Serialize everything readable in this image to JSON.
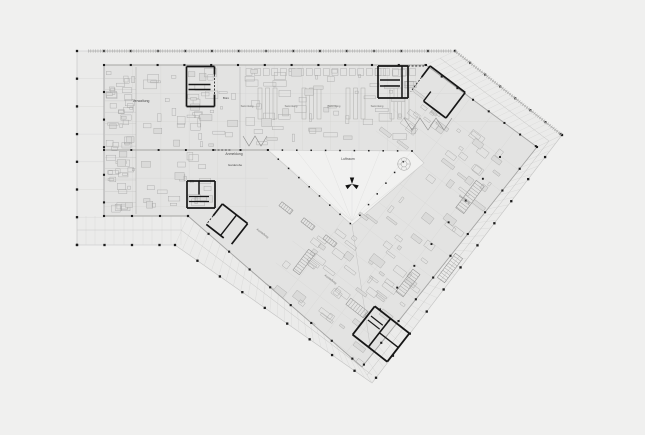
{
  "drawing_title": "floor-plan",
  "colors": {
    "bg": "#f0f0ef",
    "terrace": "#ebebea",
    "plate": "#e3e3e2",
    "void": "#f1f1f0",
    "gridLight": "#d7d7d6",
    "gridMid": "#c6c6c5",
    "edge": "#a4a4a3",
    "edgeLight": "#c2c2c1",
    "wall": "#161616",
    "column": "#1c1c1c",
    "clutter": "#a6a6a5",
    "clutterFill": "#dadad9",
    "text": "#4a4a4a",
    "textFaint": "#6e6e6d",
    "ruler": "#b2b2b1",
    "fan": "#dcdcdb"
  },
  "labels": [
    {
      "t": "Verwaltung",
      "x": 141,
      "y": 102,
      "s": 3.4,
      "r": 0
    },
    {
      "t": "Büro",
      "x": 226,
      "y": 99,
      "s": 3.0,
      "r": 0
    },
    {
      "t": "Anmeldung",
      "x": 234,
      "y": 155,
      "s": 3.4,
      "r": 0
    },
    {
      "t": "Garderobe",
      "x": 235,
      "y": 166,
      "s": 3.0,
      "r": 0
    },
    {
      "t": "Luftraum",
      "x": 348,
      "y": 160,
      "s": 3.4,
      "r": 0
    },
    {
      "t": "Sammlung",
      "x": 247,
      "y": 107,
      "s": 2.7,
      "r": 0
    },
    {
      "t": "Sammlung",
      "x": 291,
      "y": 107,
      "s": 2.7,
      "r": 0
    },
    {
      "t": "Sammlung",
      "x": 334,
      "y": 107,
      "s": 2.7,
      "r": 0
    },
    {
      "t": "Sammlung",
      "x": 377,
      "y": 107,
      "s": 2.7,
      "r": 0
    },
    {
      "t": "Sammlung",
      "x": 464,
      "y": 200,
      "s": 2.8,
      "r": 37
    },
    {
      "t": "Ausstellung",
      "x": 262,
      "y": 234,
      "s": 2.8,
      "r": 37
    },
    {
      "t": "Ausstellung",
      "x": 330,
      "y": 280,
      "s": 2.8,
      "r": 37
    }
  ],
  "geometry": {
    "terrace": [
      [
        77,
        51
      ],
      [
        455,
        51
      ],
      [
        562,
        135
      ],
      [
        372,
        383
      ],
      [
        175,
        245
      ],
      [
        77,
        245
      ]
    ],
    "plate": [
      [
        104,
        65
      ],
      [
        426,
        65
      ],
      [
        537,
        147
      ],
      [
        362,
        367
      ],
      [
        188,
        216
      ],
      [
        104,
        216
      ]
    ],
    "void": [
      [
        268,
        150
      ],
      [
        412,
        151
      ],
      [
        424,
        163
      ],
      [
        352,
        225
      ]
    ],
    "fanHub": [
      352,
      221
    ],
    "fanTargets": [
      [
        268,
        150
      ],
      [
        296,
        150
      ],
      [
        324,
        150
      ],
      [
        352,
        150
      ],
      [
        380,
        151
      ],
      [
        412,
        151
      ],
      [
        424,
        163
      ],
      [
        305,
        186
      ]
    ],
    "wingA": {
      "vxs": [
        132.6,
        160.9,
        189.2,
        217.5,
        245.8,
        274.1,
        302.4,
        330.7,
        359.0,
        387.3,
        415.6
      ],
      "vSplit": 268,
      "vy1": 51,
      "vy2a": 216,
      "vy2b": 150,
      "hys": [
        93.3,
        121.6,
        178.2,
        206.5
      ],
      "hx1": 104,
      "diagX0": 426,
      "diagY0": 65,
      "diagSlope": 1.354,
      "hx2low": 268
    },
    "leftBandYs": [
      78.7,
      106.4,
      134.1,
      161.8,
      189.5,
      217.2
    ],
    "bottomBandXs": [
      86,
      95,
      105,
      114,
      124,
      133,
      143,
      152,
      162,
      171,
      181
    ],
    "wingB": {
      "origin": [
        426,
        65
      ],
      "angle": 37.2,
      "width": 138,
      "length": 300,
      "step": 27.6
    },
    "hatches": [
      {
        "a1": [
          426,
          65
        ],
        "a2": [
          537,
          147
        ],
        "b1": [
          455,
          51
        ],
        "b2": [
          562,
          135
        ],
        "n": 22,
        "w": 0.4
      },
      {
        "a1": [
          537,
          147
        ],
        "a2": [
          362,
          367
        ],
        "b1": [
          562,
          135
        ],
        "b2": [
          372,
          383
        ],
        "n": 32,
        "w": 0.4
      },
      {
        "a1": [
          188,
          216
        ],
        "a2": [
          362,
          367
        ],
        "b1": [
          175,
          245
        ],
        "b2": [
          372,
          383
        ],
        "n": 27,
        "w": 0.4
      }
    ],
    "midlines": [
      {
        "p1": [
          181,
          230
        ],
        "p2": [
          372,
          375
        ],
        "w": 0.5
      },
      {
        "p1": [
          549,
          141
        ],
        "p2": [
          367,
          375
        ],
        "w": 0.5
      },
      {
        "p1": [
          77,
          230
        ],
        "p2": [
          182,
          230
        ],
        "w": 0.4
      },
      {
        "p1": [
          440,
          58
        ],
        "p2": [
          549,
          141
        ],
        "w": 0.5
      },
      {
        "p1": [
          352,
          225
        ],
        "p2": [
          371,
          352
        ],
        "w": 0.5
      }
    ],
    "rulers": [
      {
        "p1": [
          88,
          51
        ],
        "p2": [
          452,
          51
        ]
      },
      {
        "p1": [
          455,
          51
        ],
        "p2": [
          562,
          135
        ]
      }
    ],
    "walls": [
      {
        "p1": [
          104,
          150
        ],
        "p2": [
          268,
          150
        ],
        "w": 0.9
      },
      {
        "p1": [
          136,
          67
        ],
        "p2": [
          136,
          214
        ],
        "w": 0.5
      },
      {
        "p1": [
          104,
          216
        ],
        "p2": [
          188,
          216
        ],
        "w": 1.1
      },
      {
        "p1": [
          240,
          67
        ],
        "p2": [
          240,
          148
        ],
        "w": 0.45
      }
    ],
    "dashes": [
      [
        408,
        66,
        424,
        66
      ],
      [
        214,
        150,
        232,
        150
      ]
    ],
    "columnRuns": [
      {
        "f": [
          77,
          51
        ],
        "t": [
          455,
          51
        ],
        "st": 27.0,
        "s": 2.3
      },
      {
        "f": [
          77,
          78.7
        ],
        "t": [
          77,
          245
        ],
        "st": 27.7,
        "s": 2.3
      },
      {
        "f": [
          104,
          65
        ],
        "t": [
          426,
          65
        ],
        "st": 26.8,
        "s": 2.1
      },
      {
        "f": [
          104,
          92
        ],
        "t": [
          104,
          216
        ],
        "st": 27.6,
        "s": 2.1
      },
      {
        "f": [
          104,
          216
        ],
        "t": [
          188,
          216
        ],
        "st": 28.0,
        "s": 2.1
      },
      {
        "f": [
          77,
          245
        ],
        "t": [
          175,
          245
        ],
        "st": 27.5,
        "s": 2.3
      },
      {
        "f": [
          455,
          51
        ],
        "t": [
          562,
          135
        ],
        "st": 19.2,
        "s": 2.2
      },
      {
        "f": [
          426,
          65
        ],
        "t": [
          537,
          147
        ],
        "st": 19.5,
        "s": 2.0
      },
      {
        "f": [
          562,
          135
        ],
        "t": [
          372,
          383
        ],
        "st": 27.8,
        "s": 2.3
      },
      {
        "f": [
          537,
          147
        ],
        "t": [
          362,
          367
        ],
        "st": 27.8,
        "s": 2.1
      },
      {
        "f": [
          175,
          245
        ],
        "t": [
          372,
          383
        ],
        "st": 27.4,
        "s": 2.3
      },
      {
        "f": [
          188,
          216
        ],
        "t": [
          362,
          367
        ],
        "st": 27.2,
        "s": 2.1
      },
      {
        "f": [
          268,
          150
        ],
        "t": [
          412,
          151
        ],
        "st": 14.4,
        "s": 1.5
      },
      {
        "f": [
          268,
          150
        ],
        "t": [
          352,
          225
        ],
        "st": 13.8,
        "s": 1.5
      },
      {
        "f": [
          412,
          151
        ],
        "t": [
          352,
          225
        ],
        "st": 13.8,
        "s": 1.5
      },
      {
        "f": [
          104,
          150
        ],
        "t": [
          268,
          150
        ],
        "st": 27.3,
        "s": 1.9
      },
      {
        "f": [
          500,
          157
        ],
        "t": [
          378,
          312
        ],
        "st": 27.7,
        "s": 1.9
      }
    ],
    "cores": [
      {
        "r": 0,
        "cx": 200.5,
        "cy": 86.5,
        "segs": [
          [
            -14,
            -20,
            14,
            -20,
            1.7
          ],
          [
            -14,
            -20,
            -14,
            20,
            1.7
          ],
          [
            -14,
            20,
            14,
            20,
            1.7
          ],
          [
            14,
            8,
            14,
            20,
            1.7
          ],
          [
            14,
            -20,
            14,
            -12,
            1.7
          ],
          [
            -12,
            -2,
            10,
            -2,
            1.5
          ],
          [
            -12,
            3,
            10,
            3,
            1.5
          ],
          [
            14,
            -12,
            14,
            8,
            0.8,
            1
          ]
        ]
      },
      {
        "r": 0,
        "cx": 201,
        "cy": 194.5,
        "segs": [
          [
            -14,
            -13.5,
            14,
            -13.5,
            1.7
          ],
          [
            14,
            -13.5,
            14,
            13.5,
            1.7
          ],
          [
            14,
            13.5,
            -14,
            13.5,
            1.7
          ],
          [
            -14,
            13.5,
            -14,
            -13.5,
            1.7
          ],
          [
            -2,
            -13.5,
            -2,
            0,
            1.5
          ],
          [
            -12,
            2,
            8,
            2,
            1.3
          ],
          [
            -12,
            7,
            8,
            7,
            1.3
          ]
        ]
      },
      {
        "r": 38,
        "cx": 227,
        "cy": 224,
        "segs": [
          [
            -16,
            -13,
            16,
            -13,
            1.7
          ],
          [
            16,
            -13,
            16,
            13,
            1.7
          ],
          [
            -16,
            -13,
            -16,
            2,
            1.7
          ],
          [
            -16,
            13,
            6,
            13,
            1.7
          ],
          [
            2,
            -13,
            2,
            13,
            1.4
          ],
          [
            -16,
            2,
            -16,
            13,
            0.8,
            1
          ]
        ]
      },
      {
        "r": 0,
        "cx": 393,
        "cy": 82,
        "segs": [
          [
            -15,
            -16,
            15,
            -16,
            1.7
          ],
          [
            -15,
            -16,
            -15,
            16,
            1.7
          ],
          [
            -15,
            16,
            15,
            16,
            1.7
          ],
          [
            15,
            16,
            15,
            -16,
            1.7
          ],
          [
            9,
            -16,
            9,
            16,
            1.5
          ],
          [
            -13,
            -2,
            7,
            -2,
            1.4
          ],
          [
            -13,
            4,
            7,
            4,
            1.4
          ]
        ]
      },
      {
        "r": 37,
        "cx": 438,
        "cy": 92,
        "segs": [
          [
            -22,
            -16,
            22,
            -16,
            1.7
          ],
          [
            22,
            -16,
            22,
            16,
            1.7
          ],
          [
            22,
            16,
            -6,
            16,
            1.7
          ],
          [
            -22,
            -16,
            -22,
            -2,
            1.7
          ],
          [
            -6,
            16,
            -6,
            4,
            1.4
          ],
          [
            -22,
            -2,
            -22,
            16,
            0.8,
            1
          ]
        ]
      },
      {
        "r": 38,
        "cx": 381,
        "cy": 334,
        "segs": [
          [
            -22,
            -18,
            22,
            -18,
            1.8
          ],
          [
            22,
            -18,
            22,
            18,
            1.8
          ],
          [
            22,
            18,
            -22,
            18,
            1.8
          ],
          [
            -22,
            18,
            -22,
            -18,
            1.8
          ],
          [
            -2,
            -18,
            -2,
            18,
            1.6
          ],
          [
            -2,
            0,
            22,
            0,
            1.4
          ],
          [
            -19,
            -8,
            -4,
            -8,
            1.2
          ],
          [
            -19,
            -3,
            -4,
            -3,
            1.2
          ]
        ]
      }
    ],
    "ladders": [
      {
        "cx": 470,
        "cy": 197,
        "r": 127,
        "l": 34,
        "w": 10,
        "st": 3
      },
      {
        "cx": 450,
        "cy": 268,
        "r": 127,
        "l": 30,
        "w": 9,
        "st": 3
      },
      {
        "cx": 408,
        "cy": 283,
        "r": 127,
        "l": 28,
        "w": 9,
        "st": 3
      },
      {
        "cx": 357,
        "cy": 308,
        "r": 38,
        "l": 22,
        "w": 8,
        "st": 3
      },
      {
        "cx": 304,
        "cy": 262,
        "r": 127,
        "l": 26,
        "w": 8,
        "st": 3
      },
      {
        "cx": 286,
        "cy": 208,
        "r": 38,
        "l": 14,
        "w": 5,
        "st": 2.6
      },
      {
        "cx": 308,
        "cy": 224,
        "r": 38,
        "l": 14,
        "w": 5,
        "st": 2.6
      },
      {
        "cx": 330,
        "cy": 241,
        "r": 38,
        "l": 14,
        "w": 5,
        "st": 2.6
      }
    ],
    "zigzags": [
      [
        [
          404,
          118
        ],
        [
          412,
          130
        ],
        [
          420,
          118
        ],
        [
          428,
          130
        ],
        [
          436,
          118
        ],
        [
          444,
          130
        ],
        [
          452,
          118
        ]
      ],
      [
        [
          243,
          136
        ],
        [
          249,
          146
        ],
        [
          255,
          136
        ],
        [
          261,
          146
        ],
        [
          267,
          136
        ]
      ]
    ],
    "shelves": {
      "x0": 258,
      "dx": 44,
      "cols": 4,
      "sub": 3,
      "subdx": 7.5,
      "y": 88,
      "w": 4,
      "h": 31
    },
    "topRow": {
      "x0": 246,
      "x1": 416,
      "step": 8.6,
      "y": 68.5,
      "w": 6,
      "h": 7
    },
    "roomDividers": {
      "x1": 105,
      "x2": 136,
      "y0": 67,
      "dy": 11.3,
      "count": 12
    },
    "clutter": [
      {
        "x": 106,
        "y": 68,
        "w": 29,
        "h": 146,
        "rot": 0,
        "n": 55,
        "seed": 7,
        "mw": 9,
        "mh": 5
      },
      {
        "x": 139,
        "y": 68,
        "w": 99,
        "h": 80,
        "rot": 0,
        "n": 40,
        "seed": 11,
        "mw": 12,
        "mh": 7
      },
      {
        "x": 242,
        "y": 68,
        "w": 182,
        "h": 78,
        "rot": 0,
        "n": 55,
        "seed": 23,
        "mw": 12,
        "mh": 6
      },
      {
        "x": 139,
        "y": 152,
        "w": 76,
        "h": 60,
        "rot": 0,
        "n": 24,
        "seed": 31,
        "mw": 11,
        "mh": 6
      }
    ],
    "clutterFrame": {
      "a0": 8,
      "a1": 130,
      "b0": 25,
      "b1": 288,
      "n": 120,
      "seed": 47,
      "mw": 13,
      "mh": 6
    },
    "propeller": {
      "x": 352,
      "y": 184,
      "size": 6.5
    },
    "spiral": {
      "x": 404,
      "y": 164,
      "r1": 6.3,
      "r2": 3.0,
      "spokes": 6
    }
  }
}
